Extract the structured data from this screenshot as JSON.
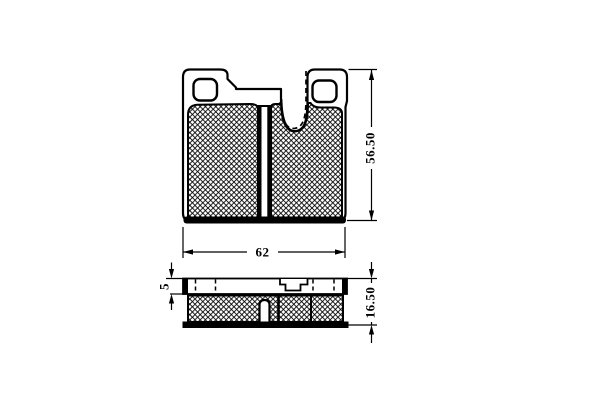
{
  "drawing": {
    "subject": "brake-pad-technical-drawing",
    "line_color": "#000000",
    "background_color": "#ffffff",
    "dims": {
      "width": "62",
      "height": "56.50",
      "backing_thickness": "5",
      "total_thickness": "16.50"
    }
  }
}
